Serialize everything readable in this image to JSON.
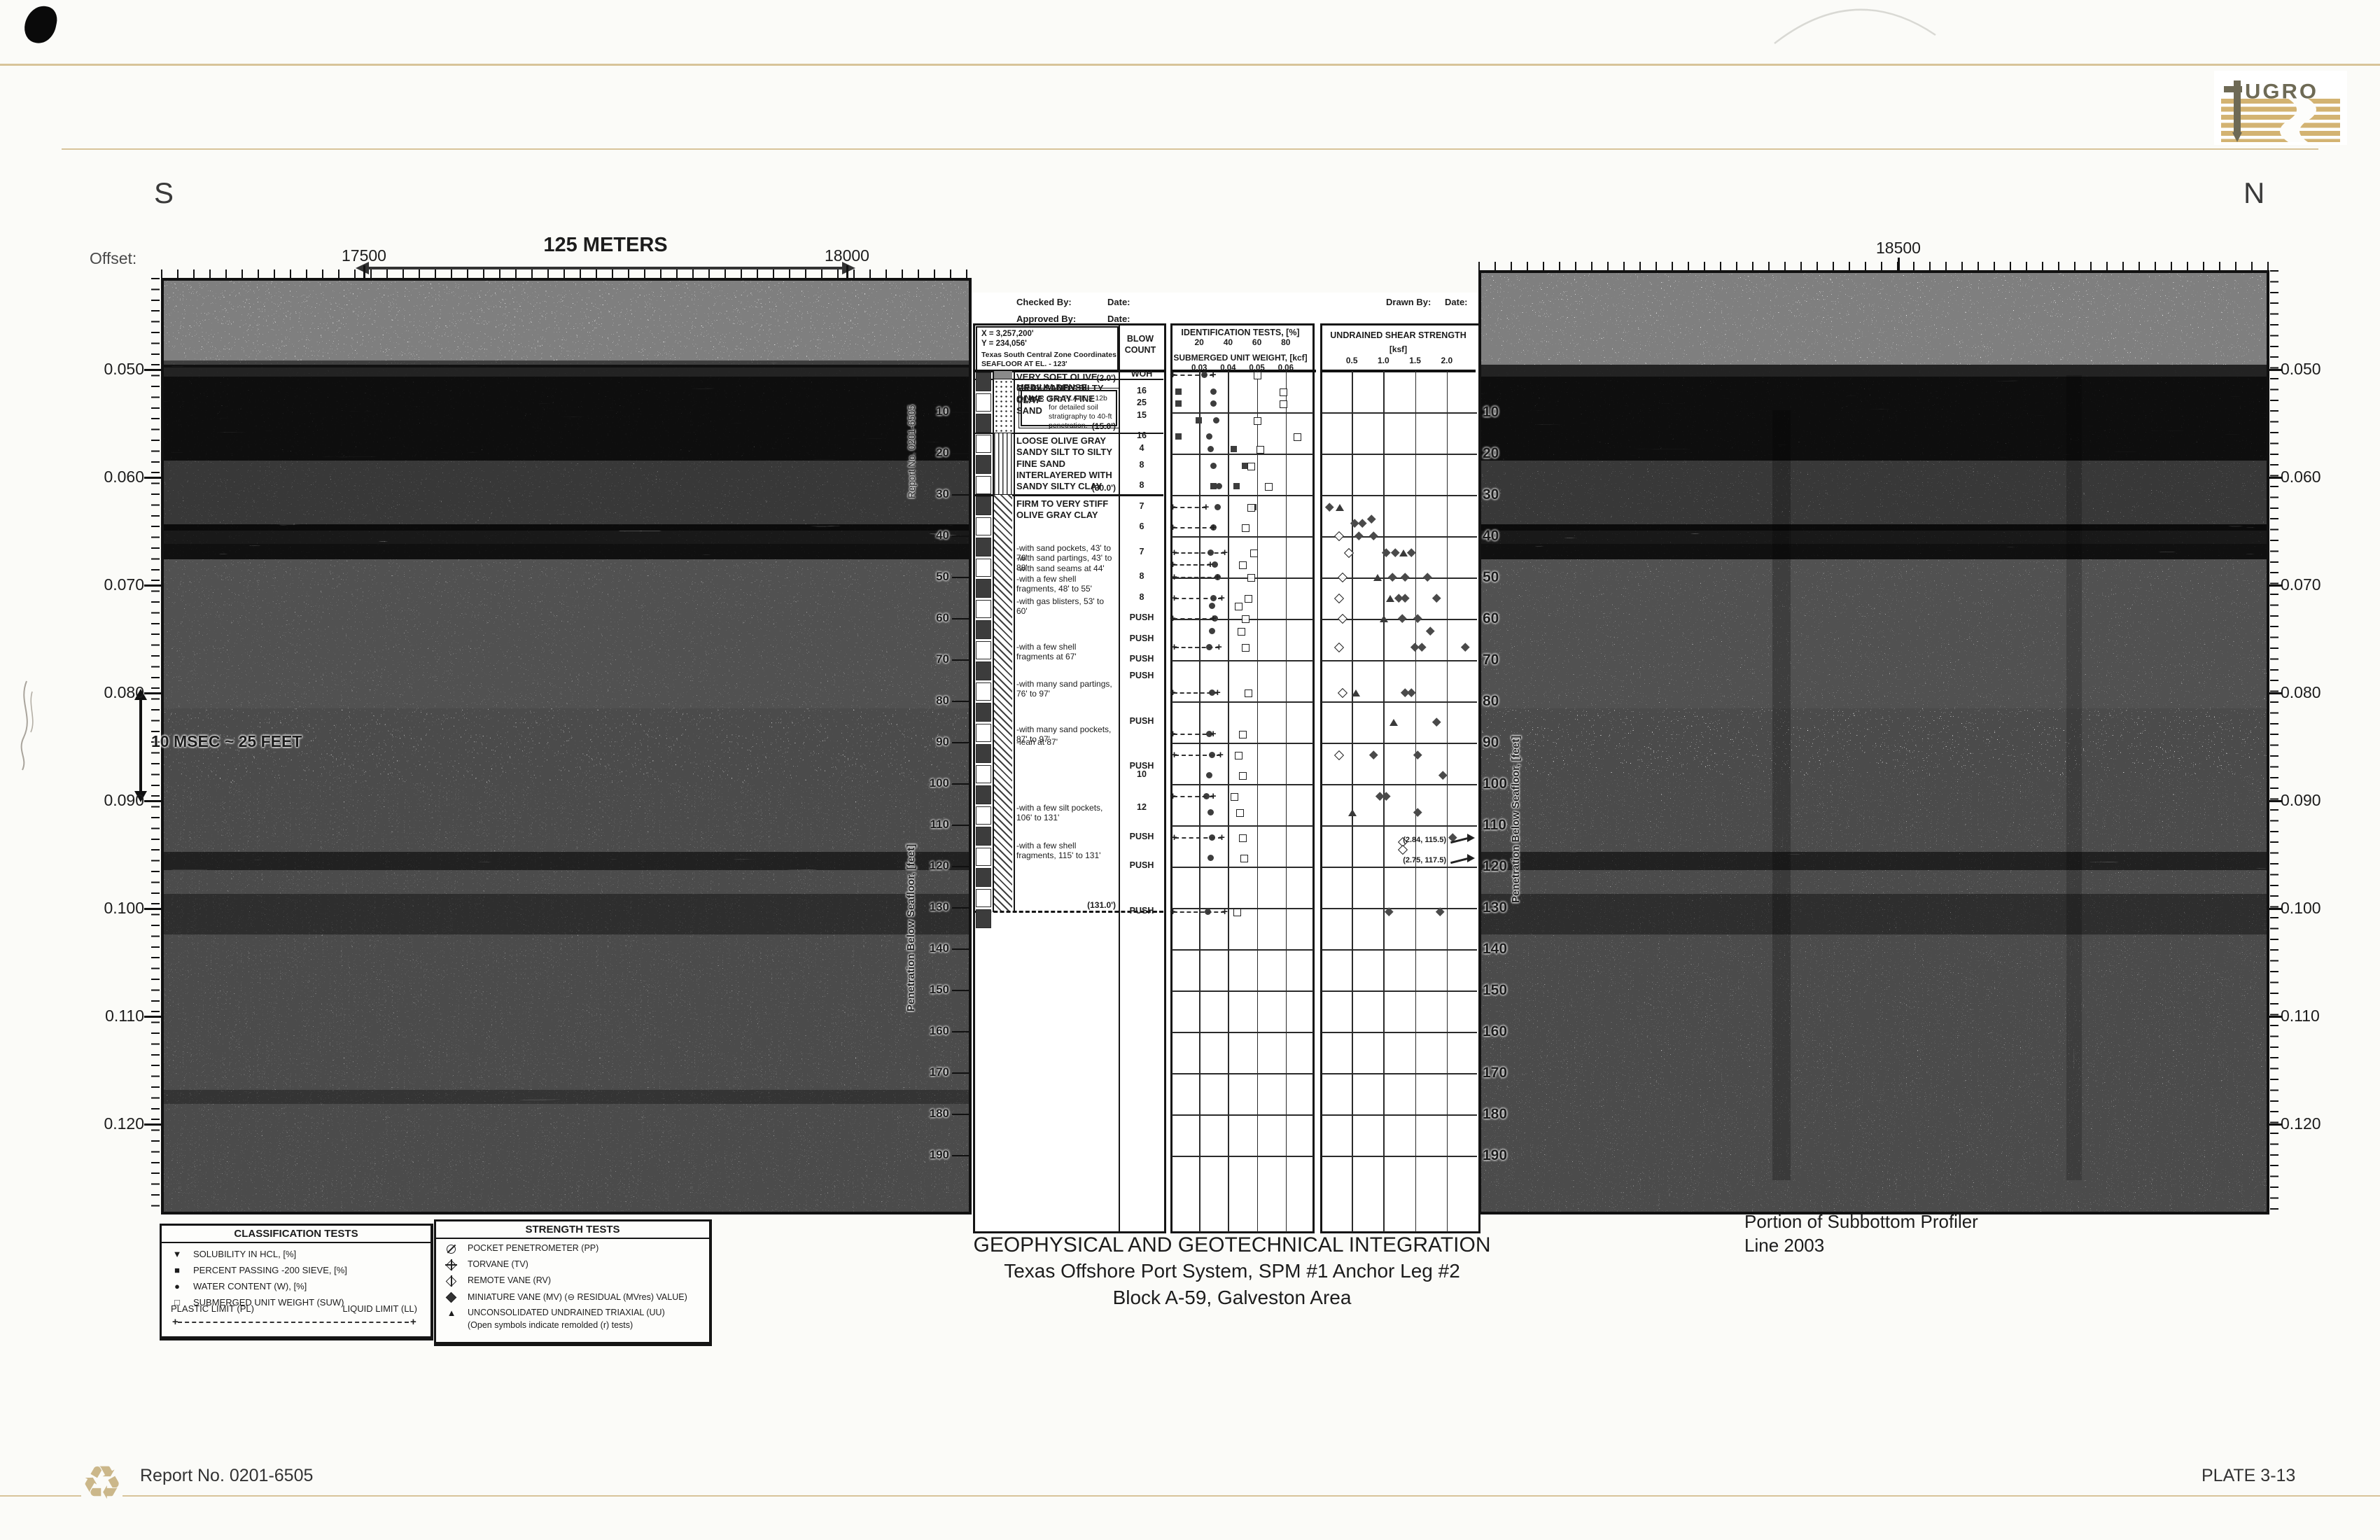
{
  "page": {
    "bg": "#fbfbf8",
    "tan": "#d8c49a",
    "ink": "#1c1c1c"
  },
  "header": {
    "logo_text": "UGRO",
    "left_direction": "S",
    "right_direction": "N",
    "offset_label": "Offset:",
    "offset_ticks": [
      "17500",
      "18000",
      "18500"
    ],
    "scale_top": "125 METERS",
    "scale_bottom": "410 FT"
  },
  "time_axis": {
    "labels": [
      "0.050",
      "0.060",
      "0.070",
      "0.080",
      "0.090",
      "0.100",
      "0.110",
      "0.120"
    ],
    "unit_note": "10 MSEC ~ 25 FEET"
  },
  "vertical_labels": {
    "report": "Report No. 0201-6505",
    "penetration": "Penetration Below Seafloor, [feet]"
  },
  "boring_log": {
    "admin": {
      "checked_by": "Checked By:",
      "approved_by": "Approved By:",
      "drawn_by": "Drawn By:",
      "date_label": "Date:"
    },
    "location": [
      "X = 3,257,200'",
      "Y = 234,056'",
      "Texas South Central Zone Coordinates",
      "SEAFLOOR AT EL. - 123'"
    ],
    "columns": {
      "blow_count": "BLOW COUNT"
    },
    "id_chart": {
      "title": "IDENTIFICATION TESTS, [%]",
      "ticks": [
        "20",
        "40",
        "60",
        "80"
      ],
      "subtitle": "SUBMERGED UNIT WEIGHT, [kcf]",
      "sub_ticks": [
        "0.03",
        "0.04",
        "0.05",
        "0.06"
      ]
    },
    "strength_chart": {
      "title": "UNDRAINED SHEAR STRENGTH",
      "unit": "[ksf]",
      "ticks": [
        "0.5",
        "1.0",
        "1.5",
        "2.0"
      ]
    },
    "note_box": {
      "label": "Note:",
      "text": "See PLATE 3-12b for detailed soil stratigraphy to 40-ft penetration."
    },
    "layers": [
      {
        "top": 0,
        "bottom": 2,
        "pattern": "claysilt",
        "description": "VERY SOFT OLIVE GRAY SANDY SILTY CLAY",
        "boundary_label": "(2.0')"
      },
      {
        "top": 2,
        "bottom": 15,
        "pattern": "sand",
        "description": "MEDIUM DENSE OLIVE GRAY FINE SAND",
        "boundary_label": "(15.0')"
      },
      {
        "top": 15,
        "bottom": 30,
        "pattern": "silt",
        "description": "LOOSE OLIVE GRAY SANDY SILT TO SILTY FINE SAND INTERLAYERED WITH SANDY SILTY CLAY",
        "boundary_label": "(30.0')"
      },
      {
        "top": 30,
        "bottom": 131,
        "pattern": "clay",
        "description": "FIRM TO VERY STIFF OLIVE GRAY CLAY",
        "boundary_label": "(131.0')",
        "boundary_dashed": true,
        "notes": [
          {
            "depth": 43,
            "text": "-with sand pockets, 43' to 76'"
          },
          {
            "depth": 45.5,
            "text": "-with sand partings, 43' to 88'"
          },
          {
            "depth": 48,
            "text": "-with sand seams at 44'"
          },
          {
            "depth": 50.5,
            "text": "-with a few shell fragments, 48' to 55'"
          },
          {
            "depth": 56,
            "text": "-with gas blisters, 53' to 60'"
          },
          {
            "depth": 67,
            "text": "-with a few shell fragments at 67'"
          },
          {
            "depth": 76,
            "text": "-with many sand partings, 76' to 97'"
          },
          {
            "depth": 87,
            "text": "-with many sand pockets, 87' to 97'"
          },
          {
            "depth": 90,
            "text": "-lean at 87'"
          },
          {
            "depth": 106,
            "text": "-with a few silt pockets, 106' to 131'"
          },
          {
            "depth": 115,
            "text": "-with a few shell fragments, 115' to 131'"
          }
        ]
      }
    ],
    "blow_counts": [
      {
        "depth": 1,
        "value": "WOH"
      },
      {
        "depth": 5,
        "value": "16"
      },
      {
        "depth": 8,
        "value": "25"
      },
      {
        "depth": 11,
        "value": "15"
      },
      {
        "depth": 16,
        "value": "16"
      },
      {
        "depth": 19,
        "value": "4"
      },
      {
        "depth": 23,
        "value": "8"
      },
      {
        "depth": 28,
        "value": "8"
      },
      {
        "depth": 33,
        "value": "7"
      },
      {
        "depth": 38,
        "value": "6"
      },
      {
        "depth": 44,
        "value": "7"
      },
      {
        "depth": 50,
        "value": "8"
      },
      {
        "depth": 55,
        "value": "8"
      },
      {
        "depth": 60,
        "value": "PUSH"
      },
      {
        "depth": 65,
        "value": "PUSH"
      },
      {
        "depth": 70,
        "value": "PUSH"
      },
      {
        "depth": 74,
        "value": "PUSH"
      },
      {
        "depth": 85,
        "value": "PUSH"
      },
      {
        "depth": 96,
        "value": "PUSH"
      },
      {
        "depth": 98,
        "value": "10"
      },
      {
        "depth": 106,
        "value": "12"
      },
      {
        "depth": 113,
        "value": "PUSH"
      },
      {
        "depth": 120,
        "value": "PUSH"
      },
      {
        "depth": 131,
        "value": "PUSH"
      }
    ],
    "depth_labels": [
      "10",
      "20",
      "30",
      "40",
      "50",
      "60",
      "70",
      "80",
      "90",
      "100",
      "110",
      "120",
      "130",
      "140",
      "150",
      "160",
      "170",
      "180",
      "190"
    ]
  },
  "chart_data": [
    {
      "type": "scatter",
      "title": "IDENTIFICATION TESTS, [%]",
      "xlabel": "IDENTIFICATION TESTS, [%] (top scale) / SUBMERGED UNIT WEIGHT, [kcf] (bottom scale)",
      "ylabel": "Penetration Below Seafloor, [feet]",
      "xlim_pct": [
        0,
        100
      ],
      "x_ticks_pct": [
        20,
        40,
        60,
        80
      ],
      "suw_tick_labels": [
        "0.03",
        "0.04",
        "0.05",
        "0.06"
      ],
      "ylim_ft": [
        0,
        190
      ],
      "grid": "10-ft horizontal gridlines",
      "series": [
        {
          "name": "WATER CONTENT (W), [%]",
          "symbol": "filled-circle",
          "points_pct_depth": [
            [
              24,
              1
            ],
            [
              30,
              5
            ],
            [
              30,
              8
            ],
            [
              32,
              12
            ],
            [
              27,
              16
            ],
            [
              28,
              19
            ],
            [
              30,
              23
            ],
            [
              34,
              28
            ],
            [
              33,
              33
            ],
            [
              30,
              38
            ],
            [
              28,
              44
            ],
            [
              31,
              47
            ],
            [
              33,
              50
            ],
            [
              30,
              55
            ],
            [
              29,
              57
            ],
            [
              31,
              60
            ],
            [
              29,
              63
            ],
            [
              27,
              67
            ],
            [
              29,
              78
            ],
            [
              27,
              88
            ],
            [
              29,
              93
            ],
            [
              27,
              98
            ],
            [
              25,
              103
            ],
            [
              28,
              107
            ],
            [
              29,
              113
            ],
            [
              28,
              118
            ],
            [
              26,
              131
            ]
          ]
        },
        {
          "name": "PERCENT PASSING -200 SIEVE, [%]",
          "symbol": "filled-square",
          "points_pct_depth": [
            [
              6,
              5
            ],
            [
              6,
              8
            ],
            [
              20,
              12
            ],
            [
              6,
              16
            ],
            [
              44,
              19
            ],
            [
              52,
              23
            ],
            [
              46,
              28
            ],
            [
              30,
              28
            ],
            [
              58,
              33
            ]
          ]
        },
        {
          "name": "SUBMERGED UNIT WEIGHT (SUW)",
          "symbol": "open-square",
          "points_pct_depth": [
            [
              60,
              1
            ],
            [
              78,
              5
            ],
            [
              78,
              8
            ],
            [
              60,
              12
            ],
            [
              88,
              16
            ],
            [
              62,
              19
            ],
            [
              56,
              23
            ],
            [
              68,
              28
            ],
            [
              56,
              33
            ],
            [
              52,
              38
            ],
            [
              58,
              44
            ],
            [
              50,
              47
            ],
            [
              56,
              50
            ],
            [
              54,
              55
            ],
            [
              47,
              57
            ],
            [
              52,
              60
            ],
            [
              49,
              63
            ],
            [
              52,
              67
            ],
            [
              54,
              78
            ],
            [
              50,
              88
            ],
            [
              47,
              93
            ],
            [
              50,
              98
            ],
            [
              44,
              103
            ],
            [
              48,
              107
            ],
            [
              50,
              113
            ],
            [
              51,
              118
            ],
            [
              46,
              131
            ]
          ]
        },
        {
          "name": "PLASTIC LIMIT (PL) to LIQUID LIMIT (LL)",
          "symbol": "plus-dashed-range",
          "ranges_pct_depth": [
            [
              2,
              30,
              1
            ],
            [
              2,
              25,
              33
            ],
            [
              2,
              30,
              38
            ],
            [
              3,
              38,
              44
            ],
            [
              2,
              28,
              47
            ],
            [
              3,
              33,
              50
            ],
            [
              3,
              36,
              55
            ],
            [
              2,
              30,
              60
            ],
            [
              3,
              34,
              67
            ],
            [
              2,
              33,
              78
            ],
            [
              2,
              30,
              88
            ],
            [
              3,
              35,
              93
            ],
            [
              2,
              30,
              103
            ],
            [
              3,
              36,
              113
            ],
            [
              2,
              38,
              131
            ]
          ]
        }
      ]
    },
    {
      "type": "scatter",
      "title": "UNDRAINED SHEAR STRENGTH [ksf]",
      "xlim_ksf": [
        0,
        2.5
      ],
      "x_ticks_ksf": [
        0.5,
        1.0,
        1.5,
        2.0
      ],
      "ylim_ft": [
        0,
        190
      ],
      "series": [
        {
          "name": "MINIATURE VANE (MV)",
          "symbol": "filled-diamond",
          "points_ksf_depth": [
            [
              0.15,
              33
            ],
            [
              0.55,
              37
            ],
            [
              0.68,
              37
            ],
            [
              0.82,
              36
            ],
            [
              0.62,
              40
            ],
            [
              0.85,
              40
            ],
            [
              1.05,
              44
            ],
            [
              1.2,
              44
            ],
            [
              1.45,
              44
            ],
            [
              1.15,
              50
            ],
            [
              1.35,
              50
            ],
            [
              1.7,
              50
            ],
            [
              1.25,
              55
            ],
            [
              1.35,
              55
            ],
            [
              1.85,
              55
            ],
            [
              1.3,
              60
            ],
            [
              1.55,
              60
            ],
            [
              1.75,
              63
            ],
            [
              1.5,
              67
            ],
            [
              1.62,
              67
            ],
            [
              2.3,
              67
            ],
            [
              1.35,
              78
            ],
            [
              1.45,
              78
            ],
            [
              1.85,
              85
            ],
            [
              0.85,
              93
            ],
            [
              1.55,
              93
            ],
            [
              1.95,
              98
            ],
            [
              0.95,
              103
            ],
            [
              1.05,
              103
            ],
            [
              1.55,
              107
            ],
            [
              2.1,
              113
            ],
            [
              1.1,
              131
            ],
            [
              1.9,
              131
            ]
          ]
        },
        {
          "name": "REMOLDED (open symbols)",
          "symbol": "open-diamond",
          "points_ksf_depth": [
            [
              0.3,
              40
            ],
            [
              0.45,
              44
            ],
            [
              0.35,
              50
            ],
            [
              0.3,
              55
            ],
            [
              0.35,
              60
            ],
            [
              0.3,
              67
            ],
            [
              0.35,
              78
            ],
            [
              0.3,
              93
            ],
            [
              1.3,
              114
            ],
            [
              1.3,
              116
            ]
          ]
        },
        {
          "name": "UNCONSOLIDATED UNDRAINED TRIAXIAL (UU)",
          "symbol": "filled-triangle",
          "points_ksf_depth": [
            [
              0.3,
              33
            ],
            [
              1.3,
              44
            ],
            [
              0.9,
              50
            ],
            [
              1.1,
              55
            ],
            [
              1.0,
              60
            ],
            [
              0.55,
              78
            ],
            [
              1.15,
              85
            ],
            [
              0.5,
              107
            ]
          ]
        }
      ],
      "offscale_annotations": [
        {
          "text": "(2.84, 115.5)",
          "plot_depth": 114
        },
        {
          "text": "(2.75, 117.5)",
          "plot_depth": 119
        }
      ]
    }
  ],
  "captions": {
    "title1": "GEOPHYSICAL AND GEOTECHNICAL INTEGRATION",
    "title2": "Texas Offshore Port System, SPM #1 Anchor Leg #2",
    "title3": "Block A-59, Galveston Area",
    "profiler1": "Portion of Subbottom Profiler",
    "profiler2": "Line 2003"
  },
  "legend_classification": {
    "title": "CLASSIFICATION TESTS",
    "items": [
      {
        "symbol": "tri-down",
        "label": "SOLUBILITY IN HCL, [%]"
      },
      {
        "symbol": "sq-filled",
        "label": "PERCENT PASSING -200 SIEVE, [%]"
      },
      {
        "symbol": "circle-filled",
        "label": "WATER CONTENT (W), [%]"
      },
      {
        "symbol": "sq-open",
        "label": "SUBMERGED UNIT WEIGHT (SUW)"
      }
    ],
    "pl_label": "PLASTIC LIMIT (PL)",
    "ll_label": "LIQUID LIMIT (LL)"
  },
  "legend_strength": {
    "title": "STRENGTH TESTS",
    "items": [
      {
        "symbol": "pp",
        "label": "POCKET PENETROMETER (PP)"
      },
      {
        "symbol": "tv",
        "label": "TORVANE (TV)"
      },
      {
        "symbol": "rv",
        "label": "REMOTE VANE (RV)"
      },
      {
        "symbol": "mv",
        "label": "MINIATURE VANE (MV)  (⊖  RESIDUAL (MVres) VALUE)"
      },
      {
        "symbol": "uu",
        "label": "UNCONSOLIDATED UNDRAINED TRIAXIAL (UU)"
      }
    ],
    "footnote": "(Open symbols indicate remolded (r) tests)"
  },
  "footer": {
    "report": "Report No. 0201-6505",
    "plate": "PLATE 3-13"
  }
}
